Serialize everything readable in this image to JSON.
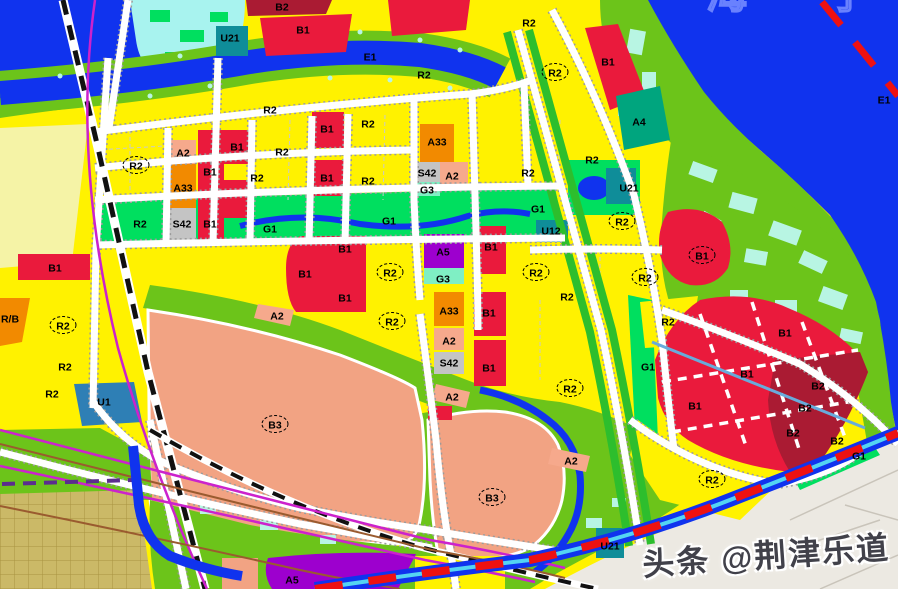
{
  "lake": {
    "name": "海 宁 湖"
  },
  "watermark": {
    "text": "头条 @荆津乐道"
  },
  "colors": {
    "water": "#1033EE",
    "shoreGreen": "#6CC41A",
    "parkGreen": "#00DF5F",
    "stripGreen": "#2DBE2D",
    "cyanWetland": "#A8F3EF",
    "cyanPatch": "#B8F5E3",
    "canalCyan": "#54D4F2",
    "roadWhite": "#FFFFFF",
    "roadCasing": "#9B9B9B",
    "rail": "#111111",
    "magenta": "#CC22CC",
    "brown": "#9A5B2F",
    "purpleLine": "#5B2D8E",
    "boundaryRed": "#EE1111",
    "outArea": "#ECE9E2",
    "outLine": "#C9C4BA",
    "khaki": "#CBB967",
    "khakiLine": "#A89440",
    "paleYellow": "#F5F3A6",
    "streamBlue": "#68ABDB",
    "labelInk": "#000000",
    "watermarkInk": "#41414A",
    "lakeNameBlue": "#6E86FF"
  },
  "zone_colors": {
    "R2": "#FFF200",
    "B1": "#EA1A3C",
    "B2": "#AA1B33",
    "B3": "#F2A383",
    "A2": "#F6A98C",
    "A33": "#F28A00",
    "A4": "#00A57E",
    "A5": "#9D00CE",
    "S42": "#C4C4C4",
    "G1": "#00DF5F",
    "G3": "#7FEFC4",
    "U1": "#2E7FB5",
    "U12": "#0F8D99",
    "U21": "#0F8D99",
    "RB": "#F28A00",
    "E1": "#1033EE"
  },
  "labels": [
    {
      "t": "U21",
      "x": 230,
      "y": 38
    },
    {
      "t": "B2",
      "x": 282,
      "y": 7
    },
    {
      "t": "B1",
      "x": 303,
      "y": 30
    },
    {
      "t": "E1",
      "x": 370,
      "y": 57
    },
    {
      "t": "R2",
      "x": 424,
      "y": 75
    },
    {
      "t": "R2",
      "x": 529,
      "y": 23
    },
    {
      "t": "R2",
      "x": 555,
      "y": 73,
      "c": 1
    },
    {
      "t": "B1",
      "x": 608,
      "y": 62
    },
    {
      "t": "A4",
      "x": 639,
      "y": 122
    },
    {
      "t": "E1",
      "x": 884,
      "y": 100
    },
    {
      "t": "R2",
      "x": 270,
      "y": 110
    },
    {
      "t": "R2",
      "x": 136,
      "y": 166,
      "c": 1
    },
    {
      "t": "A2",
      "x": 183,
      "y": 153
    },
    {
      "t": "B1",
      "x": 210,
      "y": 172
    },
    {
      "t": "B1",
      "x": 237,
      "y": 147
    },
    {
      "t": "R2",
      "x": 282,
      "y": 152
    },
    {
      "t": "B1",
      "x": 327,
      "y": 129
    },
    {
      "t": "R2",
      "x": 368,
      "y": 124
    },
    {
      "t": "A33",
      "x": 183,
      "y": 188
    },
    {
      "t": "R2",
      "x": 257,
      "y": 178
    },
    {
      "t": "B1",
      "x": 327,
      "y": 178
    },
    {
      "t": "R2",
      "x": 368,
      "y": 181
    },
    {
      "t": "A33",
      "x": 437,
      "y": 142
    },
    {
      "t": "S42",
      "x": 427,
      "y": 173
    },
    {
      "t": "A2",
      "x": 452,
      "y": 176
    },
    {
      "t": "G3",
      "x": 427,
      "y": 190
    },
    {
      "t": "R2",
      "x": 528,
      "y": 173
    },
    {
      "t": "R2",
      "x": 592,
      "y": 160
    },
    {
      "t": "U21",
      "x": 629,
      "y": 188
    },
    {
      "t": "R2",
      "x": 140,
      "y": 224
    },
    {
      "t": "S42",
      "x": 182,
      "y": 224
    },
    {
      "t": "B1",
      "x": 210,
      "y": 224
    },
    {
      "t": "G1",
      "x": 270,
      "y": 229
    },
    {
      "t": "G1",
      "x": 389,
      "y": 221
    },
    {
      "t": "G1",
      "x": 538,
      "y": 209
    },
    {
      "t": "U12",
      "x": 551,
      "y": 231
    },
    {
      "t": "R2",
      "x": 622,
      "y": 222,
      "c": 1
    },
    {
      "t": "B1",
      "x": 345,
      "y": 249
    },
    {
      "t": "A5",
      "x": 443,
      "y": 252
    },
    {
      "t": "B1",
      "x": 491,
      "y": 247
    },
    {
      "t": "B1",
      "x": 702,
      "y": 256,
      "c": 1
    },
    {
      "t": "B1",
      "x": 305,
      "y": 274
    },
    {
      "t": "R2",
      "x": 390,
      "y": 273,
      "c": 1
    },
    {
      "t": "G3",
      "x": 443,
      "y": 279
    },
    {
      "t": "R2",
      "x": 536,
      "y": 273,
      "c": 1
    },
    {
      "t": "R2",
      "x": 645,
      "y": 278,
      "c": 1
    },
    {
      "t": "B1",
      "x": 345,
      "y": 298
    },
    {
      "t": "R2",
      "x": 567,
      "y": 297
    },
    {
      "t": "A2",
      "x": 277,
      "y": 316
    },
    {
      "t": "A33",
      "x": 449,
      "y": 311
    },
    {
      "t": "B1",
      "x": 489,
      "y": 313
    },
    {
      "t": "R2",
      "x": 392,
      "y": 322,
      "c": 1
    },
    {
      "t": "R/B",
      "x": 10,
      "y": 319
    },
    {
      "t": "R2",
      "x": 63,
      "y": 326,
      "c": 1
    },
    {
      "t": "R2",
      "x": 668,
      "y": 322
    },
    {
      "t": "B1",
      "x": 785,
      "y": 333
    },
    {
      "t": "A2",
      "x": 449,
      "y": 341
    },
    {
      "t": "S42",
      "x": 449,
      "y": 363
    },
    {
      "t": "B1",
      "x": 489,
      "y": 368
    },
    {
      "t": "G1",
      "x": 648,
      "y": 367
    },
    {
      "t": "R2",
      "x": 65,
      "y": 367
    },
    {
      "t": "B1",
      "x": 55,
      "y": 268
    },
    {
      "t": "B1",
      "x": 747,
      "y": 374
    },
    {
      "t": "B2",
      "x": 818,
      "y": 386
    },
    {
      "t": "R2",
      "x": 570,
      "y": 389,
      "c": 1
    },
    {
      "t": "R2",
      "x": 52,
      "y": 394
    },
    {
      "t": "U1",
      "x": 104,
      "y": 402
    },
    {
      "t": "A2",
      "x": 452,
      "y": 397
    },
    {
      "t": "B1",
      "x": 695,
      "y": 406
    },
    {
      "t": "B2",
      "x": 805,
      "y": 408
    },
    {
      "t": "B3",
      "x": 275,
      "y": 425,
      "c": 1
    },
    {
      "t": "B2",
      "x": 793,
      "y": 433
    },
    {
      "t": "B2",
      "x": 837,
      "y": 441
    },
    {
      "t": "G1",
      "x": 859,
      "y": 456
    },
    {
      "t": "A2",
      "x": 571,
      "y": 461
    },
    {
      "t": "R2",
      "x": 712,
      "y": 480,
      "c": 1
    },
    {
      "t": "B3",
      "x": 492,
      "y": 498,
      "c": 1
    },
    {
      "t": "U21",
      "x": 610,
      "y": 546
    },
    {
      "t": "A5",
      "x": 292,
      "y": 580
    }
  ]
}
